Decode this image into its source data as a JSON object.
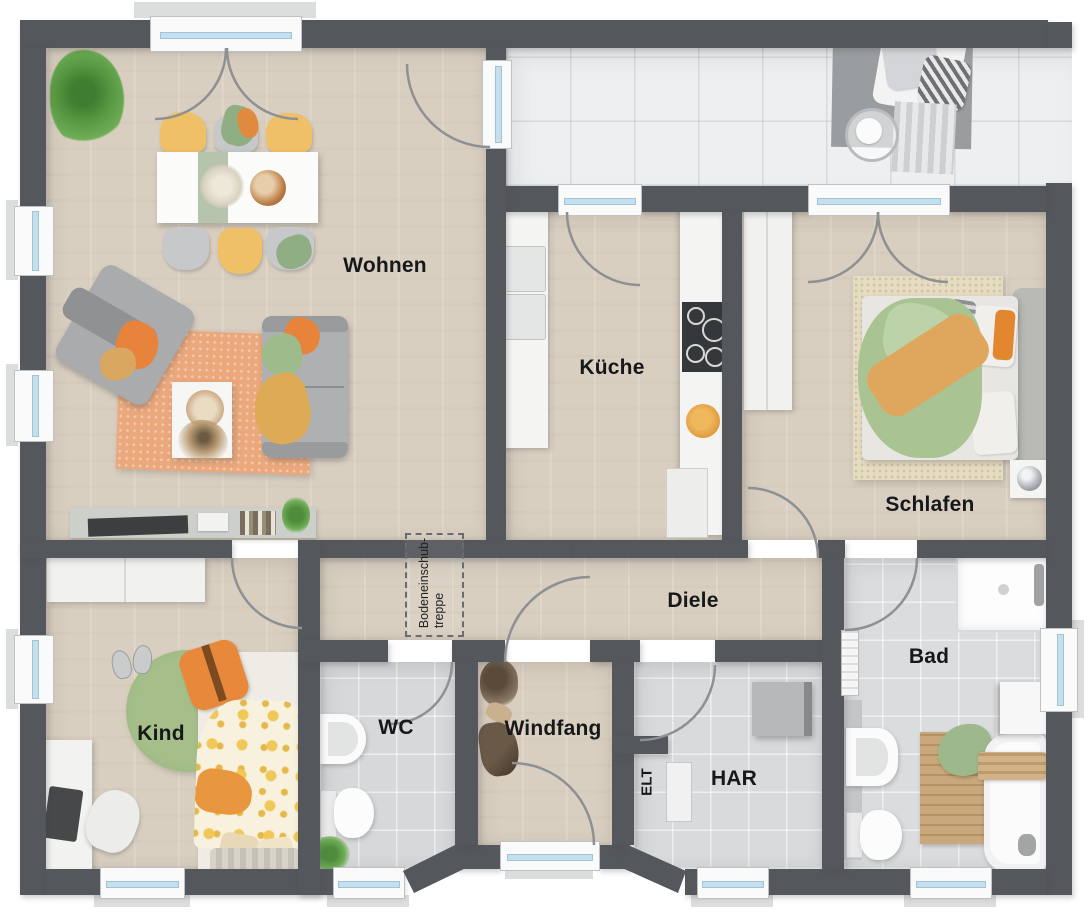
{
  "plan": {
    "type": "residential-floor-plan",
    "rooms": {
      "wohnen": {
        "label": "Wohnen"
      },
      "kueche": {
        "label": "Küche"
      },
      "schlafen": {
        "label": "Schlafen"
      },
      "diele": {
        "label": "Diele"
      },
      "bad": {
        "label": "Bad"
      },
      "kind": {
        "label": "Kind"
      },
      "wc": {
        "label": "WC"
      },
      "windfang": {
        "label": "Windfang"
      },
      "elt": {
        "label": "ELT"
      },
      "har": {
        "label": "HAR"
      }
    },
    "annotations": {
      "attic_stairs": {
        "line1": "Bodeneinschub-",
        "line2": "treppe"
      }
    },
    "colors": {
      "wall": "#54575c",
      "wood_floor": "#d9cfc1",
      "tile_floor": "#d6d8da",
      "terrace_floor": "#edeff1",
      "window_glass": "#c5e0ec",
      "accent_orange": "#e8833c",
      "accent_green": "#9dbb8b",
      "accent_yellow": "#f0c066"
    }
  }
}
